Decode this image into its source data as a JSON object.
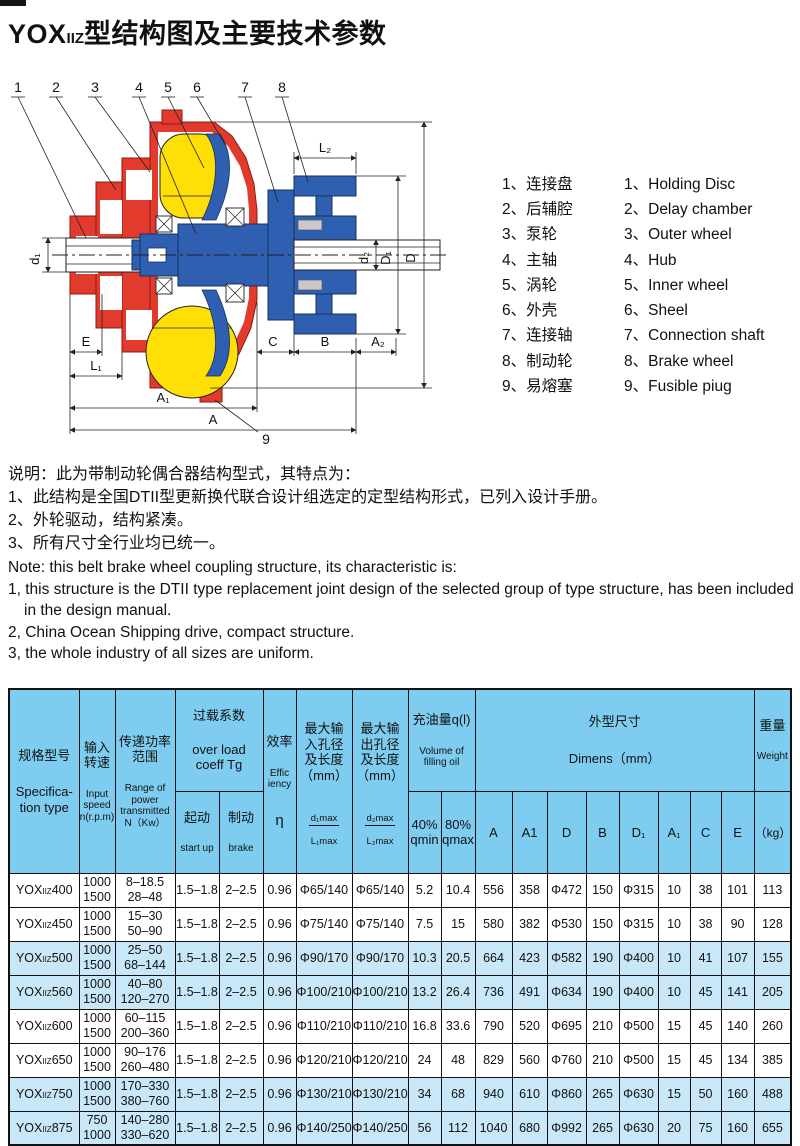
{
  "title": {
    "prefix": "YOX",
    "sub": "IIZ",
    "rest": "型结构图及主要技术参数"
  },
  "diagram": {
    "callouts": [
      "1",
      "2",
      "3",
      "4",
      "5",
      "6",
      "7",
      "8",
      "9"
    ],
    "dims": {
      "d1": "d₁",
      "E": "E",
      "L1": "L₁",
      "A1": "A₁",
      "A": "A",
      "C": "C",
      "B": "B",
      "A2": "A₂",
      "L2": "L₂",
      "d2": "d₂",
      "D1": "D₁",
      "D": "D"
    }
  },
  "parts": {
    "items": [
      {
        "cn": "1、连接盘",
        "en": "1、Holding Disc"
      },
      {
        "cn": "2、后辅腔",
        "en": "2、Delay chamber"
      },
      {
        "cn": "3、泵轮",
        "en": "3、Outer wheel"
      },
      {
        "cn": "4、主轴",
        "en": "4、Hub"
      },
      {
        "cn": "5、涡轮",
        "en": "5、Inner wheel"
      },
      {
        "cn": "6、外壳",
        "en": "6、Sheel"
      },
      {
        "cn": "7、连接轴",
        "en": "7、Connection shaft"
      },
      {
        "cn": "8、制动轮",
        "en": "8、Brake wheel"
      },
      {
        "cn": "9、易熔塞",
        "en": "9、Fusible piug"
      }
    ]
  },
  "notes": {
    "cn": [
      "说明：此为带制动轮偶合器结构型式，其特点为：",
      "1、此结构是全国DTII型更新换代联合设计组选定的定型结构形式，已列入设计手册。",
      "2、外轮驱动，结构紧凑。",
      "3、所有尺寸全行业均已统一。"
    ],
    "en": [
      "Note: this belt brake wheel coupling structure, its characteristic is:",
      "1, this structure is the DTII type replacement joint design of the selected group of type structure, has been included in the design manual.",
      "2, China Ocean Shipping drive, compact structure.",
      "3, the whole industry of all sizes are uniform."
    ]
  },
  "table": {
    "header": {
      "spec_cn": "规格型号",
      "spec_en": "Specifica-\ntion type",
      "speed_cn": "输入\n转速",
      "speed_en": "Input\nspeed\nn(r.p.m)",
      "power_cn": "传递功率\n范围",
      "power_en": "Range of\npower\ntransmitted\nN（Kw）",
      "overload_cn": "过载系数",
      "overload_en": "over load\ncoeff Tg",
      "startup_cn": "起动",
      "startup_en": "start up",
      "brake_cn": "制动",
      "brake_en": "brake",
      "eff_cn": "效率",
      "eff_en": "Effic\niency",
      "eff_sym": "η",
      "in_cn": "最大输\n入孔径\n及长度\n（mm）",
      "in_frac_top": "d₁max",
      "in_frac_bot": "L₁max",
      "out_cn": "最大输\n出孔径\n及长度\n（mm）",
      "out_frac_top": "d₂max",
      "out_frac_bot": "L₂max",
      "oil_cn": "充油量q(l)",
      "oil_en": "Volume of\nfilling oil",
      "qmin": "40%\nqmin",
      "qmax": "80%\nqmax",
      "dims_cn": "外型尺寸",
      "dims_en": "Dimens（mm）",
      "dim_cols": [
        "A",
        "A1",
        "D",
        "B",
        "D₁",
        "A₁",
        "C",
        "E"
      ],
      "weight_cn": "重量",
      "weight_en": "Weight",
      "weight_unit": "（kg）"
    },
    "rows": [
      {
        "model": {
          "prefix": "YOX",
          "sub": "IIZ",
          "num": "400"
        },
        "speed": "1000\n1500",
        "power": "8–18.5\n28–48",
        "values": [
          "1.5–1.8",
          "2–2.5",
          "0.96",
          "Φ65/140",
          "Φ65/140",
          "5.2",
          "10.4",
          "556",
          "358",
          "Φ472",
          "150",
          "Φ315",
          "10",
          "38",
          "101",
          "113"
        ],
        "shaded": false
      },
      {
        "model": {
          "prefix": "YOX",
          "sub": "IIZ",
          "num": "450"
        },
        "speed": "1000\n1500",
        "power": "15–30\n50–90",
        "values": [
          "1.5–1.8",
          "2–2.5",
          "0.96",
          "Φ75/140",
          "Φ75/140",
          "7.5",
          "15",
          "580",
          "382",
          "Φ530",
          "150",
          "Φ315",
          "10",
          "38",
          "90",
          "128"
        ],
        "shaded": false
      },
      {
        "model": {
          "prefix": "YOX",
          "sub": "IIZ",
          "num": "500"
        },
        "speed": "1000\n1500",
        "power": "25–50\n68–144",
        "values": [
          "1.5–1.8",
          "2–2.5",
          "0.96",
          "Φ90/170",
          "Φ90/170",
          "10.3",
          "20.5",
          "664",
          "423",
          "Φ582",
          "190",
          "Φ400",
          "10",
          "41",
          "107",
          "155"
        ],
        "shaded": true
      },
      {
        "model": {
          "prefix": "YOX",
          "sub": "IIZ",
          "num": "560"
        },
        "speed": "1000\n1500",
        "power": "40–80\n120–270",
        "values": [
          "1.5–1.8",
          "2–2.5",
          "0.96",
          "Φ100/210",
          "Φ100/210",
          "13.2",
          "26.4",
          "736",
          "491",
          "Φ634",
          "190",
          "Φ400",
          "10",
          "45",
          "141",
          "205"
        ],
        "shaded": true
      },
      {
        "model": {
          "prefix": "YOX",
          "sub": "IIZ",
          "num": "600"
        },
        "speed": "1000\n1500",
        "power": "60–115\n200–360",
        "values": [
          "1.5–1.8",
          "2–2.5",
          "0.96",
          "Φ110/210",
          "Φ110/210",
          "16.8",
          "33.6",
          "790",
          "520",
          "Φ695",
          "210",
          "Φ500",
          "15",
          "45",
          "140",
          "260"
        ],
        "shaded": false
      },
      {
        "model": {
          "prefix": "YOX",
          "sub": "IIZ",
          "num": "650"
        },
        "speed": "1000\n1500",
        "power": "90–176\n260–480",
        "values": [
          "1.5–1.8",
          "2–2.5",
          "0.96",
          "Φ120/210",
          "Φ120/210",
          "24",
          "48",
          "829",
          "560",
          "Φ760",
          "210",
          "Φ500",
          "15",
          "45",
          "134",
          "385"
        ],
        "shaded": false
      },
      {
        "model": {
          "prefix": "YOX",
          "sub": "IIZ",
          "num": "750"
        },
        "speed": "1000\n1500",
        "power": "170–330\n380–760",
        "values": [
          "1.5–1.8",
          "2–2.5",
          "0.96",
          "Φ130/210",
          "Φ130/210",
          "34",
          "68",
          "940",
          "610",
          "Φ860",
          "265",
          "Φ630",
          "15",
          "50",
          "160",
          "488"
        ],
        "shaded": true
      },
      {
        "model": {
          "prefix": "YOX",
          "sub": "IIZ",
          "num": "875"
        },
        "speed": "750\n1000",
        "power": "140–280\n330–620",
        "values": [
          "1.5–1.8",
          "2–2.5",
          "0.96",
          "Φ140/250",
          "Φ140/250",
          "56",
          "112",
          "1040",
          "680",
          "Φ992",
          "265",
          "Φ630",
          "20",
          "75",
          "160",
          "655"
        ],
        "shaded": true
      }
    ]
  }
}
